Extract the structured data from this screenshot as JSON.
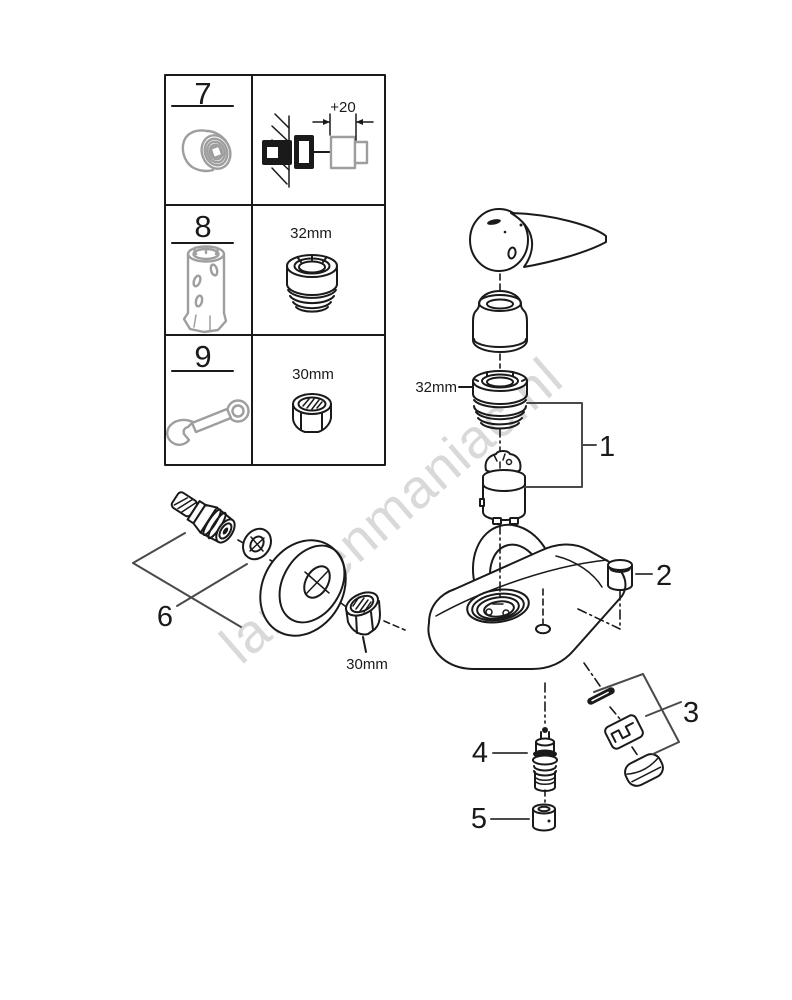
{
  "watermark": {
    "text": "lampenmaniac.nl"
  },
  "legend": {
    "rows": [
      {
        "number": "7",
        "tool_icon": "extension-nipple-icon",
        "dimension": "+20"
      },
      {
        "number": "8",
        "tool_icon": "socket-tool-icon",
        "size": "32mm"
      },
      {
        "number": "9",
        "tool_icon": "open-end-wrench-icon",
        "size": "30mm"
      }
    ]
  },
  "diagram": {
    "size_labels": {
      "ring_nut": "32mm",
      "union_nut": "30mm"
    },
    "callouts": [
      "1",
      "2",
      "3",
      "4",
      "5",
      "6"
    ]
  },
  "colors": {
    "line": "#1a1a1a",
    "gray_part": "#9e9e9e",
    "watermark": "#d9d9d9"
  }
}
